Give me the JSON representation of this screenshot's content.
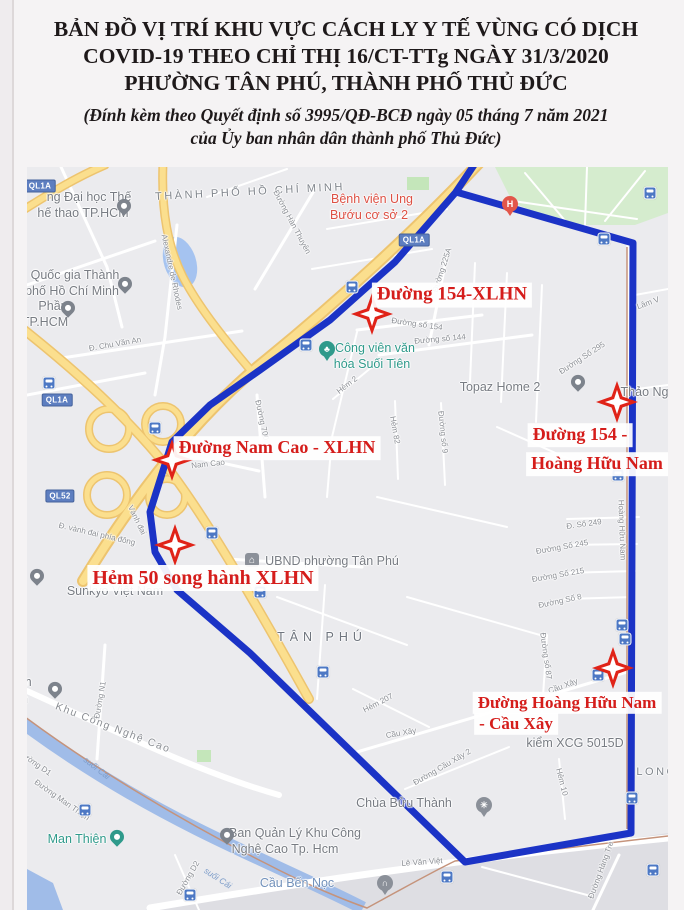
{
  "header": {
    "title_lines": [
      "BẢN ĐỒ VỊ TRÍ KHU VỰC CÁCH LY Y TẾ VÙNG CÓ DỊCH",
      "COVID-19 THEO CHỈ THỊ 16/CT-TTg NGÀY 31/3/2020",
      "PHƯỜNG TÂN PHÚ, THÀNH PHỐ THỦ ĐỨC"
    ],
    "subtitle_lines": [
      "(Đính kèm theo Quyết định số 3995/QĐ-BCĐ ngày 05 tháng 7 năm 2021",
      "của Ủy ban nhân dân thành phố Thủ Đức)"
    ]
  },
  "colors": {
    "zone_outline_blue": "#1b33c6",
    "marker_red": "#e02318",
    "label_red": "#d51d1b",
    "highway_yellow": "#fbdf8e",
    "water_blue": "#a0bce8",
    "park_green": "#d5ecce"
  },
  "map": {
    "quarantine_labels": [
      {
        "text": "Đường 154-XLHN",
        "x": 425,
        "y": 128,
        "size": 19
      },
      {
        "text": "Đường Nam Cao - XLHN",
        "x": 250,
        "y": 281,
        "size": 18
      },
      {
        "text": "Hẻm 50 song hành XLHN",
        "x": 176,
        "y": 411,
        "size": 20
      },
      {
        "text": "Đường 154 -",
        "x": 553,
        "y": 268,
        "size": 18
      },
      {
        "text": "Hoàng Hữu Nam",
        "x": 570,
        "y": 297,
        "size": 18
      },
      {
        "text": "Đường Hoàng Hữu Nam",
        "x": 540,
        "y": 536,
        "size": 17
      },
      {
        "text": "- Cầu Xây",
        "x": 489,
        "y": 557,
        "size": 17
      }
    ],
    "stars": [
      {
        "x": 345,
        "y": 147
      },
      {
        "x": 590,
        "y": 235
      },
      {
        "x": 145,
        "y": 293
      },
      {
        "x": 148,
        "y": 378
      },
      {
        "x": 586,
        "y": 501
      }
    ],
    "labels": [
      {
        "text": "THÀNH PHỐ HỒ CHÍ MINH",
        "x": 223,
        "y": 25,
        "cls": "area",
        "rot": -3
      },
      {
        "text": "TÂN PHÚ",
        "x": 295,
        "y": 470,
        "cls": "area area-lg"
      },
      {
        "text": "LONG",
        "x": 630,
        "y": 605,
        "cls": "area"
      },
      {
        "text": "ng Đại học Thế",
        "x": 62,
        "y": 30,
        "cls": "poi"
      },
      {
        "text": "hế thao TP.HCM",
        "x": 56,
        "y": 46,
        "cls": "poi"
      },
      {
        "text": "Quốc gia Thành",
        "x": 48,
        "y": 108,
        "cls": "poi"
      },
      {
        "text": "phố Hồ Chí Minh",
        "x": 45,
        "y": 124,
        "cls": "poi"
      },
      {
        "text": "Phần",
        "x": 26,
        "y": 139,
        "cls": "poi"
      },
      {
        "text": "TP.HCM",
        "x": 18,
        "y": 155,
        "cls": "poi"
      },
      {
        "text": "Bệnh viện Ung",
        "x": 345,
        "y": 32,
        "cls": "poi poi-red"
      },
      {
        "text": "Bướu cơ sở 2",
        "x": 342,
        "y": 48,
        "cls": "poi poi-red"
      },
      {
        "text": "Công viên văn",
        "x": 348,
        "y": 181,
        "cls": "poi poi-teal"
      },
      {
        "text": "hóa Suối Tiên",
        "x": 345,
        "y": 197,
        "cls": "poi poi-teal"
      },
      {
        "text": "Topaz Home 2",
        "x": 473,
        "y": 220,
        "cls": "poi"
      },
      {
        "text": "Thảo Ngu",
        "x": 621,
        "y": 225,
        "cls": "poi"
      },
      {
        "text": "UBND phường Tân Phú",
        "x": 305,
        "y": 394,
        "cls": "poi"
      },
      {
        "text": "Sunkyo Việt Nam",
        "x": 88,
        "y": 424,
        "cls": "poi"
      },
      {
        "text": "kiểm XCG 5015D",
        "x": 548,
        "y": 576,
        "cls": "poi"
      },
      {
        "text": "Ban Quản Lý Khu Công",
        "x": 268,
        "y": 666,
        "cls": "poi"
      },
      {
        "text": "Nghệ Cao Tp. Hcm",
        "x": 258,
        "y": 682,
        "cls": "poi"
      },
      {
        "text": "Chùa Bửu Thành",
        "x": 377,
        "y": 636,
        "cls": "poi"
      },
      {
        "text": "am",
        "x": -4,
        "y": 515,
        "cls": "poi"
      },
      {
        "text": "on",
        "x": -6,
        "y": 532,
        "cls": "poi"
      },
      {
        "text": "Man Thiện",
        "x": 50,
        "y": 672,
        "cls": "poi poi-teal"
      },
      {
        "text": "Cầu Bến Nọc",
        "x": 270,
        "y": 716,
        "cls": "poi poi-blue"
      },
      {
        "text": "Đ. Chu Văn An",
        "x": 88,
        "y": 177,
        "cls": "street",
        "rot": -10
      },
      {
        "text": "Alexandre de Rhodes",
        "x": 145,
        "y": 105,
        "cls": "street",
        "rot": 78
      },
      {
        "text": "Đường Hàn Thuyên",
        "x": 265,
        "y": 55,
        "cls": "street",
        "rot": 62
      },
      {
        "text": "Đường số 154",
        "x": 390,
        "y": 157,
        "cls": "street",
        "rot": 8
      },
      {
        "text": "Đường số 144",
        "x": 413,
        "y": 172,
        "cls": "street",
        "rot": -5
      },
      {
        "text": "Đường 225A",
        "x": 415,
        "y": 103,
        "cls": "street",
        "rot": -72
      },
      {
        "text": "Hẻm 2",
        "x": 320,
        "y": 218,
        "cls": "street",
        "rot": -38
      },
      {
        "text": "Hẻm 82",
        "x": 368,
        "y": 263,
        "cls": "street",
        "rot": 80
      },
      {
        "text": "Đường số 9",
        "x": 416,
        "y": 265,
        "cls": "street",
        "rot": 84
      },
      {
        "text": "Lâm V",
        "x": 621,
        "y": 136,
        "cls": "street",
        "rot": -20
      },
      {
        "text": "Đường Số 295",
        "x": 555,
        "y": 191,
        "cls": "street",
        "rot": -33
      },
      {
        "text": "Nam Cao",
        "x": 181,
        "y": 297,
        "cls": "street",
        "rot": -6
      },
      {
        "text": "Đường 700",
        "x": 235,
        "y": 253,
        "cls": "street",
        "rot": 78
      },
      {
        "text": "Vành đai",
        "x": 110,
        "y": 353,
        "cls": "street",
        "rot": 64
      },
      {
        "text": "Đ. vành đai phía đông",
        "x": 70,
        "y": 367,
        "cls": "street",
        "rot": 13
      },
      {
        "text": "Hẻm 207",
        "x": 351,
        "y": 536,
        "cls": "street",
        "rot": -27
      },
      {
        "text": "Cầu Xây",
        "x": 374,
        "y": 566,
        "cls": "street",
        "rot": -10
      },
      {
        "text": "Đường Cầu Xây 2",
        "x": 415,
        "y": 600,
        "cls": "street",
        "rot": -30
      },
      {
        "text": "Cầu Xây",
        "x": 536,
        "y": 519,
        "cls": "street",
        "rot": -20
      },
      {
        "text": "Hẻm 10",
        "x": 535,
        "y": 615,
        "cls": "street",
        "rot": 76
      },
      {
        "text": "Đ. Số 249",
        "x": 557,
        "y": 357,
        "cls": "street",
        "rot": -8
      },
      {
        "text": "Đường Số 245",
        "x": 535,
        "y": 380,
        "cls": "street",
        "rot": -10
      },
      {
        "text": "Đường Số 215",
        "x": 531,
        "y": 408,
        "cls": "street",
        "rot": -10
      },
      {
        "text": "Đường Số 8",
        "x": 533,
        "y": 434,
        "cls": "street",
        "rot": -12
      },
      {
        "text": "Đường số 87",
        "x": 519,
        "y": 489,
        "cls": "street",
        "rot": 82
      },
      {
        "text": "Hoàng Hữu Nam",
        "x": 595,
        "y": 363,
        "cls": "street",
        "rot": 88
      },
      {
        "text": "Đường Hàng Tre",
        "x": 574,
        "y": 703,
        "cls": "street",
        "rot": -70
      },
      {
        "text": "Khu Công Nghệ Cao",
        "x": 86,
        "y": 561,
        "cls": "street-lg",
        "rot": 21
      },
      {
        "text": "Đường N1",
        "x": 73,
        "y": 533,
        "cls": "street",
        "rot": -80
      },
      {
        "text": "Đường D1",
        "x": 8,
        "y": 596,
        "cls": "street",
        "rot": 35
      },
      {
        "text": "Đường Man Thiện",
        "x": 35,
        "y": 633,
        "cls": "street",
        "rot": 35
      },
      {
        "text": "Đường D2",
        "x": 161,
        "y": 711,
        "cls": "street",
        "rot": -60
      },
      {
        "text": "Lê Văn Việt",
        "x": 395,
        "y": 695,
        "cls": "street",
        "rot": -4
      },
      {
        "text": "suối Cái",
        "x": 70,
        "y": 601,
        "cls": "water",
        "rot": 38
      },
      {
        "text": "suối Cái",
        "x": 191,
        "y": 711,
        "cls": "water",
        "rot": 33
      }
    ],
    "road_badges": [
      {
        "text": "QL1A",
        "x": 13,
        "y": 19
      },
      {
        "text": "QL1A",
        "x": 387,
        "y": 73
      },
      {
        "text": "QL1A",
        "x": 30,
        "y": 233
      },
      {
        "text": "QL52",
        "x": 33,
        "y": 329
      }
    ],
    "bus_stops": [
      {
        "x": 623,
        "y": 26
      },
      {
        "x": 577,
        "y": 72
      },
      {
        "x": 325,
        "y": 120
      },
      {
        "x": 279,
        "y": 178
      },
      {
        "x": 22,
        "y": 216
      },
      {
        "x": 128,
        "y": 261
      },
      {
        "x": 591,
        "y": 308
      },
      {
        "x": 185,
        "y": 366
      },
      {
        "x": 233,
        "y": 425
      },
      {
        "x": 595,
        "y": 458
      },
      {
        "x": 598,
        "y": 472
      },
      {
        "x": 296,
        "y": 505
      },
      {
        "x": 571,
        "y": 508
      },
      {
        "x": 605,
        "y": 631
      },
      {
        "x": 58,
        "y": 643
      },
      {
        "x": 626,
        "y": 703
      },
      {
        "x": 420,
        "y": 710
      },
      {
        "x": 163,
        "y": 728
      }
    ],
    "pins": [
      {
        "name": "university-pin",
        "shape": "drop",
        "color": "#7d838c",
        "x": 97,
        "y": 45
      },
      {
        "name": "university-pin",
        "shape": "drop",
        "color": "#7d838c",
        "x": 98,
        "y": 123
      },
      {
        "name": "poi-pin",
        "shape": "drop",
        "color": "#7d838c",
        "x": 41,
        "y": 147
      },
      {
        "name": "hospital-pin",
        "shape": "circle",
        "color": "#e2564a",
        "glyph": "H",
        "x": 483,
        "y": 37
      },
      {
        "name": "park-pin",
        "shape": "circle",
        "color": "#2f9a8b",
        "glyph": "♣",
        "x": 300,
        "y": 182
      },
      {
        "name": "place-pin",
        "shape": "drop",
        "color": "#7d838c",
        "x": 551,
        "y": 221
      },
      {
        "name": "government-office-icon",
        "shape": "square",
        "color": "#8b9099",
        "glyph": "⌂",
        "x": 225,
        "y": 393
      },
      {
        "name": "poi-pin",
        "shape": "drop",
        "color": "#7d838c",
        "x": 10,
        "y": 415
      },
      {
        "name": "poi-pin",
        "shape": "drop",
        "color": "#7d838c",
        "x": 28,
        "y": 528
      },
      {
        "name": "place-pin",
        "shape": "drop",
        "color": "#2f9a8b",
        "x": 90,
        "y": 676
      },
      {
        "name": "management-board-pin",
        "shape": "drop",
        "color": "#7d838c",
        "x": 200,
        "y": 674
      },
      {
        "name": "pagoda-pin",
        "shape": "circle",
        "color": "#8b9099",
        "glyph": "✳",
        "x": 457,
        "y": 638
      },
      {
        "name": "bridge-pin",
        "shape": "circle",
        "color": "#8b9099",
        "glyph": "∩",
        "x": 358,
        "y": 716
      }
    ]
  }
}
